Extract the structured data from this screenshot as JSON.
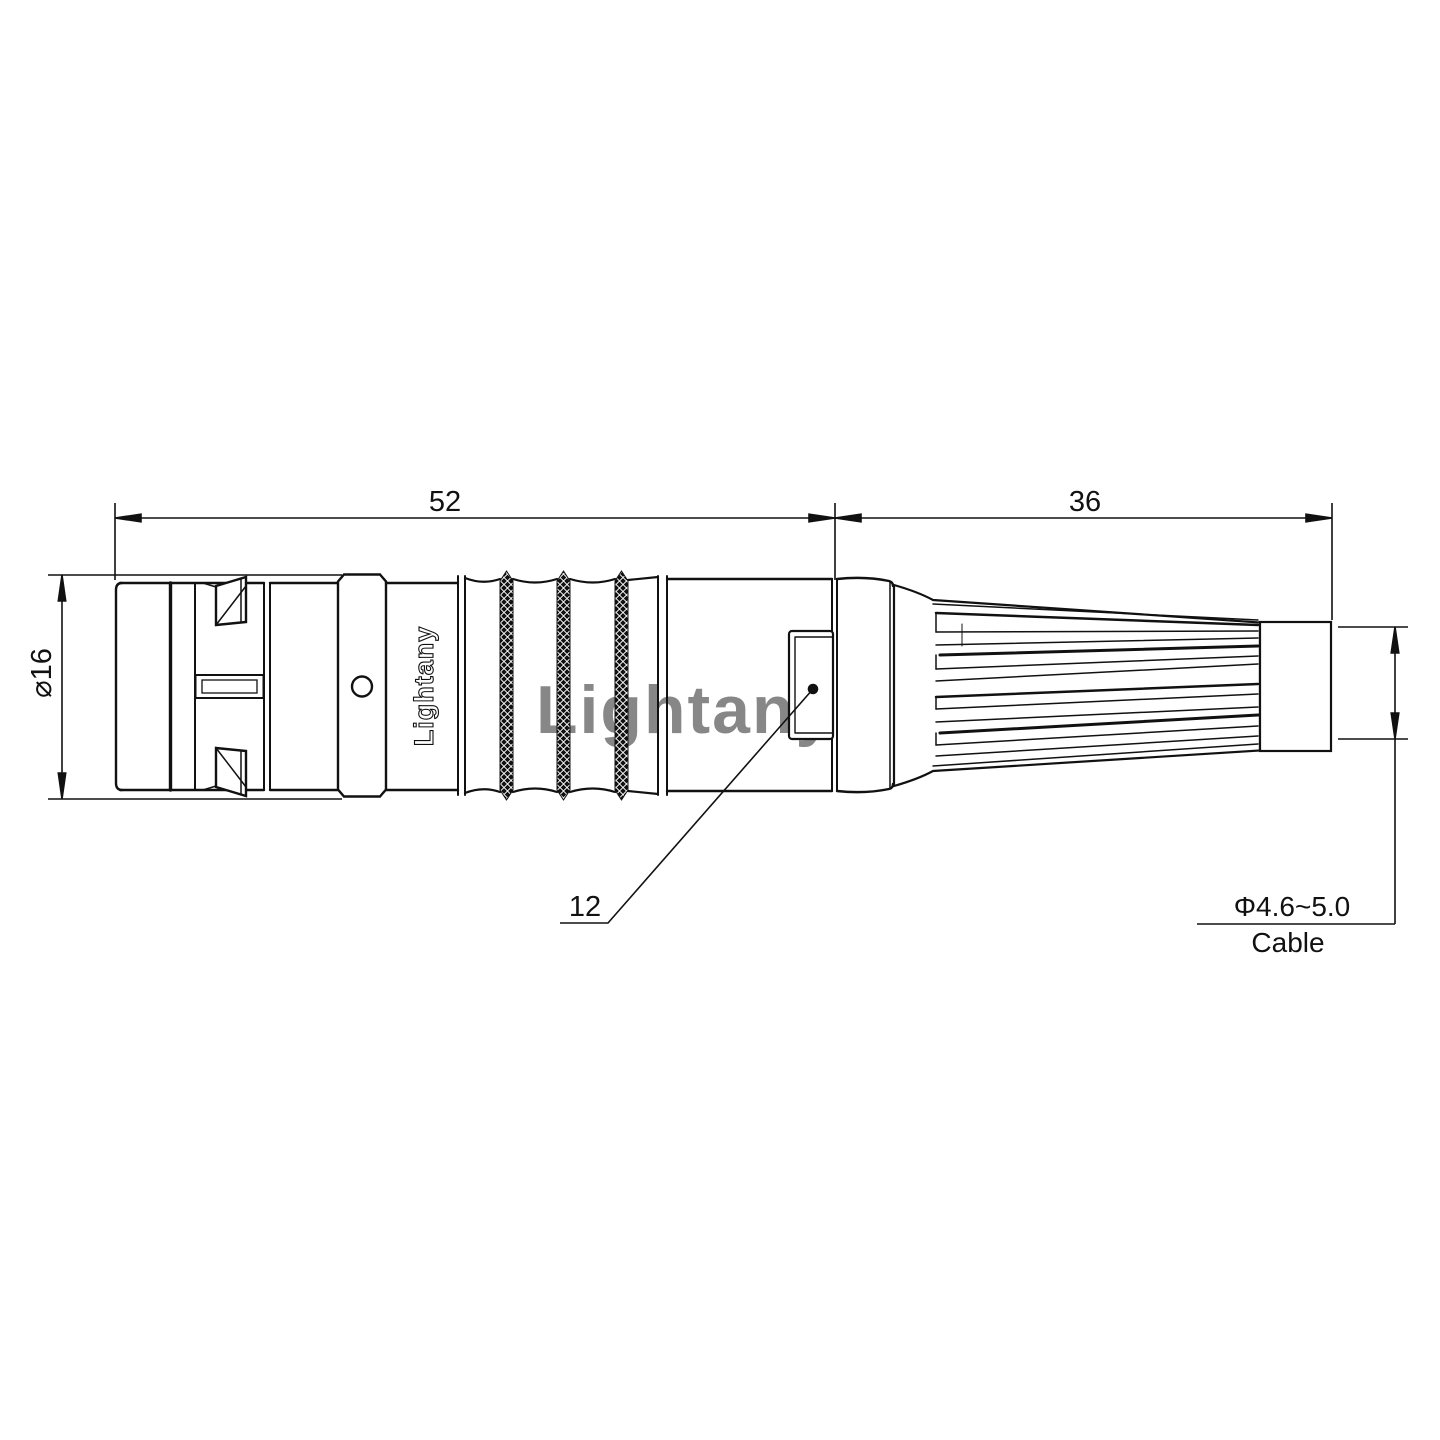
{
  "drawing": {
    "watermark": "Lightany",
    "logo": "Lightany",
    "dims": {
      "front_length": "52",
      "rear_length": "36",
      "outer_diameter": "⌀16",
      "nut_width": "12",
      "cable_diameter": "Φ4.6~5.0",
      "cable_label": "Cable"
    },
    "colors": {
      "line": "#111111",
      "watermark": "#e89c9c",
      "background": "#ffffff"
    }
  }
}
